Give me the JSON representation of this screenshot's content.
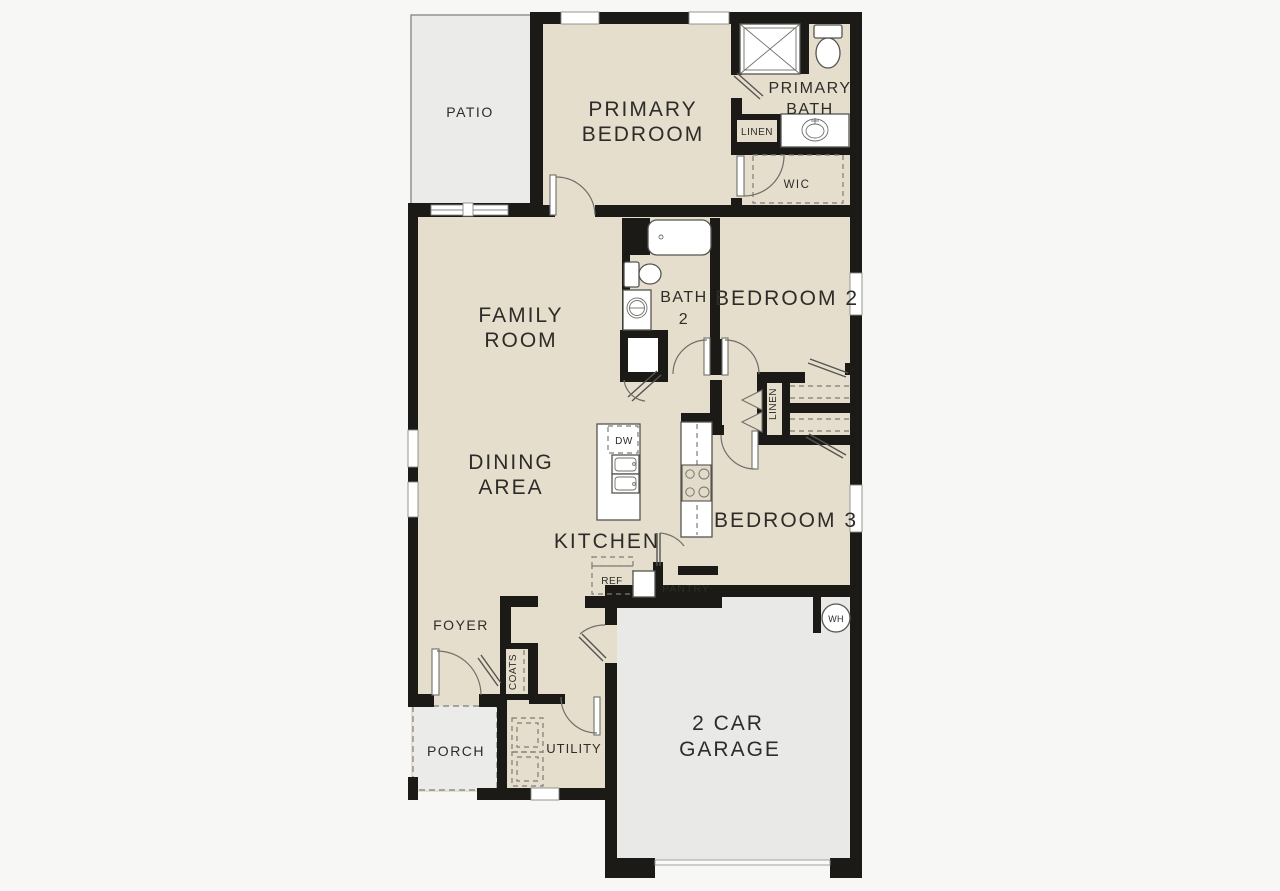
{
  "labels": {
    "patio": "PATIO",
    "primary_bedroom_line1": "PRIMARY",
    "primary_bedroom_line2": "BEDROOM",
    "primary_bath_line1": "PRIMARY",
    "primary_bath_line2": "BATH",
    "linen_primary": "LINEN",
    "wic": "WIC",
    "family_room_line1": "FAMILY",
    "family_room_line2": "ROOM",
    "bath2_line1": "BATH",
    "bath2_line2": "2",
    "bedroom2": "BEDROOM 2",
    "linen_hall": "LINEN",
    "dining_line1": "DINING",
    "dining_line2": "AREA",
    "kitchen": "KITCHEN",
    "dishwasher": "DW",
    "bedroom3": "BEDROOM 3",
    "refrigerator": "REF",
    "pantry": "PANTRY",
    "foyer": "FOYER",
    "coats": "COATS",
    "porch": "PORCH",
    "utility": "UTILITY",
    "garage_line1": "2 CAR",
    "garage_line2": "GARAGE",
    "water_heater": "WH"
  },
  "colors": {
    "background": "#f7f7f6",
    "interior_fill": "#e6decd",
    "outdoor_fill": "#ebebea",
    "garage_fill": "#e9e9e8",
    "wall": "#1b1a17",
    "line": "#6f6f69",
    "text": "#2d2c28"
  }
}
